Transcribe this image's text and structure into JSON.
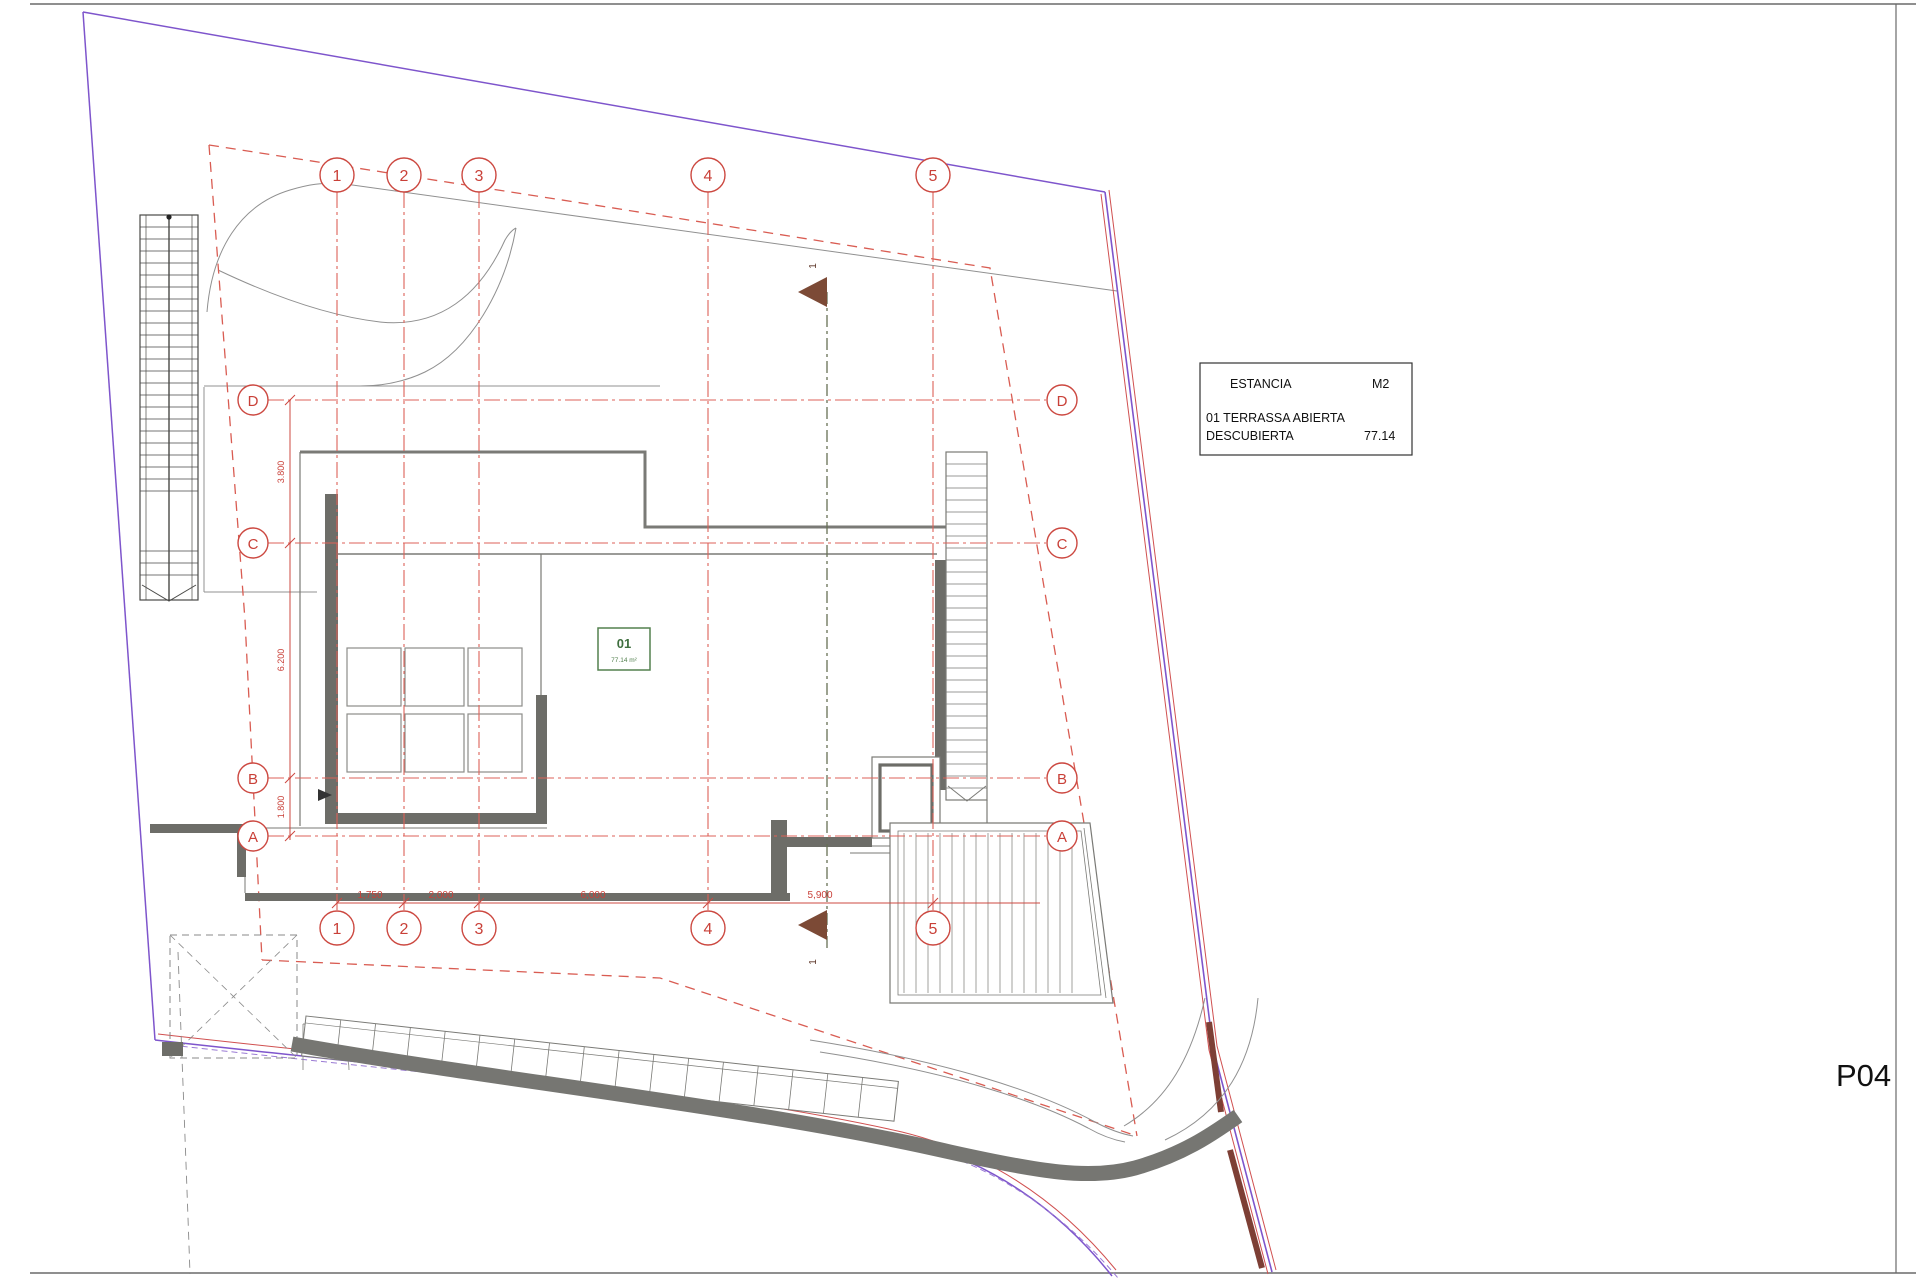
{
  "sheet": {
    "code": "P04"
  },
  "legend": {
    "header_left": "ESTANCIA",
    "header_right": "M2",
    "row_label_line1": "01 TERRASSA ABIERTA",
    "row_label_line2": "DESCUBIERTA",
    "row_value": "77.14"
  },
  "room_tag": {
    "number": "01",
    "area": "77.14 m²"
  },
  "grid": {
    "columns": [
      "1",
      "2",
      "3",
      "4",
      "5"
    ],
    "rows": [
      "D",
      "C",
      "B",
      "A"
    ]
  },
  "dimensions": {
    "horizontal": [
      "1,750",
      "2,000",
      "6,000",
      "5,900"
    ],
    "vertical": [
      "3.800",
      "6.200",
      "1.800"
    ]
  },
  "section": {
    "label": "1"
  },
  "colors": {
    "grid_red": "#dd6258",
    "bubble_red": "#cc4840",
    "setback_red": "#d95c52",
    "boundary_purple": "#7e55cc",
    "boundary_red": "#d05050",
    "wall_gray": "#6d6d68",
    "line_gray": "#8f8f8b",
    "section_olive": "#667055",
    "marker_brown": "#7c4a36",
    "tag_green": "#53814f"
  }
}
